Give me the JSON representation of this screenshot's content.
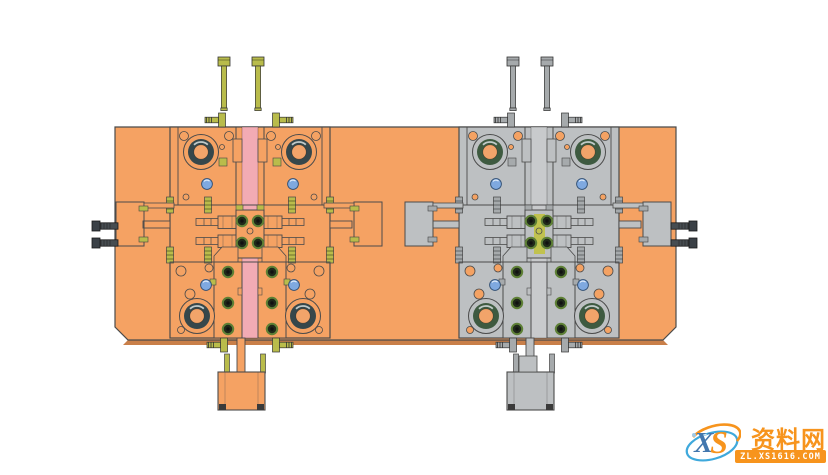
{
  "watermark": {
    "logo_x": "X",
    "logo_s": "S",
    "site_name": "资料网",
    "site_url": "ZL.XS1616.COM"
  },
  "colors": {
    "background": "#ffffff",
    "plate_orange": "#F5A263",
    "plate_edge_dark": "#C97F49",
    "outline": "#4b4b4b",
    "pink_channel": "#F2ABB4",
    "khaki_hardware": "#B9BC4B",
    "gray_part": "#BDC0C2",
    "gray_hardware": "#A6AAAC",
    "socket_screw_green": "#5E8036",
    "water_port_blue": "#7FA9E0",
    "bolt_dark": "#474D51",
    "bushing_ring_dark": "#36474B",
    "bushing_ring_green": "#3E5A40",
    "insert_strip_yellow": "#C1C24F",
    "watermark_orange": "#F7941D",
    "watermark_blue": "#3FA9DC",
    "logo_x_blue": "#4377AE"
  },
  "scene": {
    "components": [
      "mold-base-plate",
      "left-mold-assembly-orange",
      "right-mold-assembly-gray",
      "socket-cap-screws",
      "guide-bushings",
      "cooling-ports",
      "side-clamp-blocks",
      "hose-fittings",
      "sprue-channel",
      "ejector-tail-block"
    ]
  }
}
